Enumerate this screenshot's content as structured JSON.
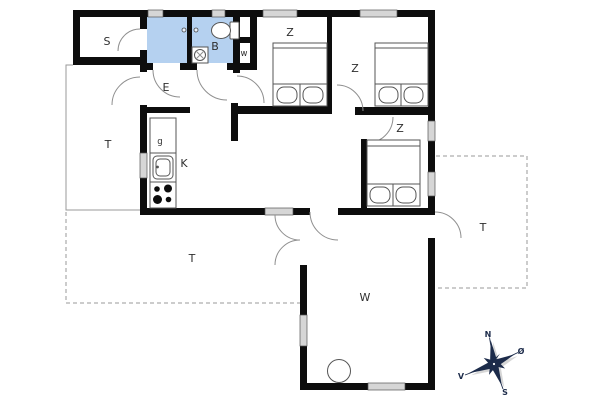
{
  "plan": {
    "type": "house-floor-plan",
    "colors": {
      "wall": "#0d0d0d",
      "bathroom_fill": "#b5d1f0",
      "window_fill": "#d6d6d6",
      "door_arc": "#8f8f8f",
      "terrace_line": "#9a9a9a",
      "compass": "#1c2b4a",
      "background": "#ffffff"
    },
    "rooms": [
      {
        "id": "storage",
        "label": "S"
      },
      {
        "id": "bathroom",
        "label": "B"
      },
      {
        "id": "wc-closet",
        "label": "w"
      },
      {
        "id": "entrance",
        "label": "E"
      },
      {
        "id": "terrace-left",
        "label": "T"
      },
      {
        "id": "fridge-cabinet",
        "label": "g"
      },
      {
        "id": "kitchen",
        "label": "K"
      },
      {
        "id": "bedroom-1",
        "label": "Z"
      },
      {
        "id": "bedroom-2",
        "label": "Z"
      },
      {
        "id": "bedroom-3",
        "label": "Z"
      },
      {
        "id": "living-room",
        "label": "W"
      },
      {
        "id": "terrace-bottom",
        "label": "T"
      },
      {
        "id": "terrace-right",
        "label": "T"
      }
    ],
    "compass": {
      "north": "N",
      "east": "Ø",
      "south": "S",
      "west": "V"
    }
  }
}
